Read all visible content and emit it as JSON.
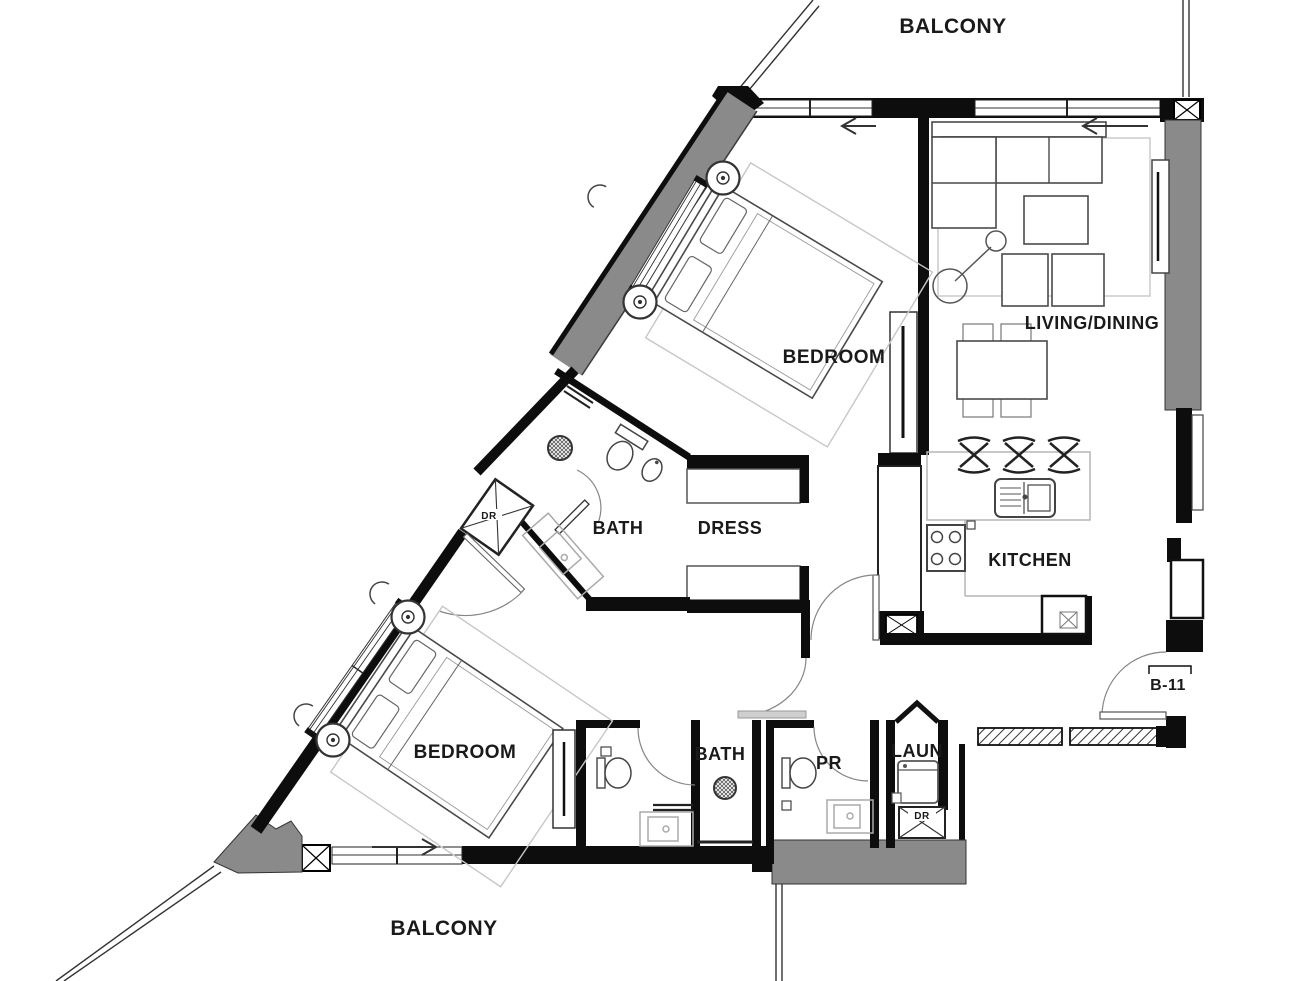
{
  "floorplan": {
    "unit_number": "B-11",
    "labels": {
      "balcony_top": "BALCONY",
      "balcony_bottom": "BALCONY",
      "bedroom_top": "BEDROOM",
      "bedroom_bottom": "BEDROOM",
      "living_dining": "LIVING/DINING",
      "kitchen": "KITCHEN",
      "bath_top": "BATH",
      "dress": "DRESS",
      "bath_bottom": "BATH",
      "powder_room": "PR",
      "laundry": "LAUN",
      "unit_tag": "B-11",
      "duct_top": "DR",
      "duct_bottom": "DR"
    },
    "colors": {
      "wall": "#0d0d0d",
      "shear_wall": "#8a8a8a",
      "furniture_line": "#4a4a4a",
      "light_line": "#b5b5b5",
      "background": "#ffffff"
    }
  }
}
